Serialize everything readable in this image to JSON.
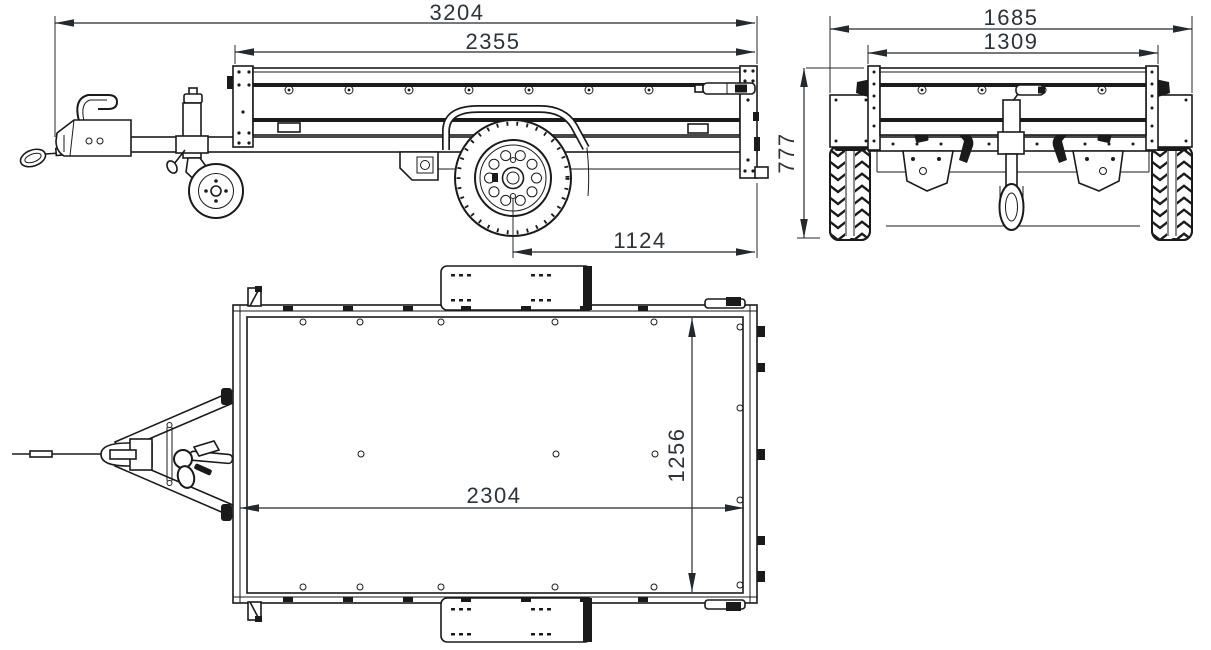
{
  "drawing": {
    "background_color": "#ffffff",
    "line_color": "#1a1a1a",
    "dimension_text_color": "#2b333b",
    "views": {
      "side_view": {
        "dimensions": {
          "overall_length": "3204",
          "box_length": "2355",
          "axle_to_rear": "1124"
        }
      },
      "end_view": {
        "dimensions": {
          "overall_width": "1685",
          "box_width": "1309",
          "overall_height": "777"
        }
      },
      "top_view": {
        "dimensions": {
          "bed_inner_length": "2304",
          "bed_inner_width": "1256"
        }
      }
    }
  }
}
